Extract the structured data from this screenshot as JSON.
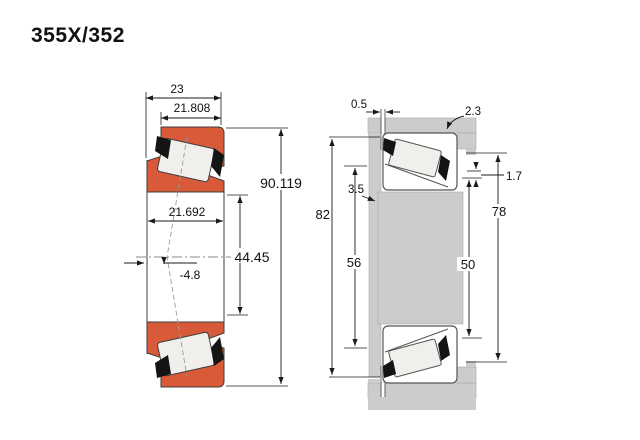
{
  "title": "355X/352",
  "left_diagram": {
    "description": "tapered-roller-bearing-cross-section",
    "dims": {
      "width_total": "23",
      "cup_width": "21.808",
      "cone_width": "21.692",
      "outer_diameter": "90.119",
      "bore_diameter": "44.45",
      "load_center_offset": "-4.8"
    }
  },
  "right_diagram": {
    "description": "bearing-mounted-abutment-dimensions",
    "dims": {
      "backing_clearance": "0.5",
      "housing_fillet_radius": "2.3",
      "shaft_fillet_radius": "3.5",
      "shoulder_step": "1.7",
      "shaft_backing_diameter": "82",
      "shaft_abutment_diameter": "56",
      "housing_abutment_diameter": "50",
      "housing_backing_diameter": "78"
    }
  },
  "colors": {
    "ring_orange": "#d85a38",
    "steel_gray": "#cdcccb",
    "roller_white": "#f1efec",
    "cage_black": "#141414"
  }
}
